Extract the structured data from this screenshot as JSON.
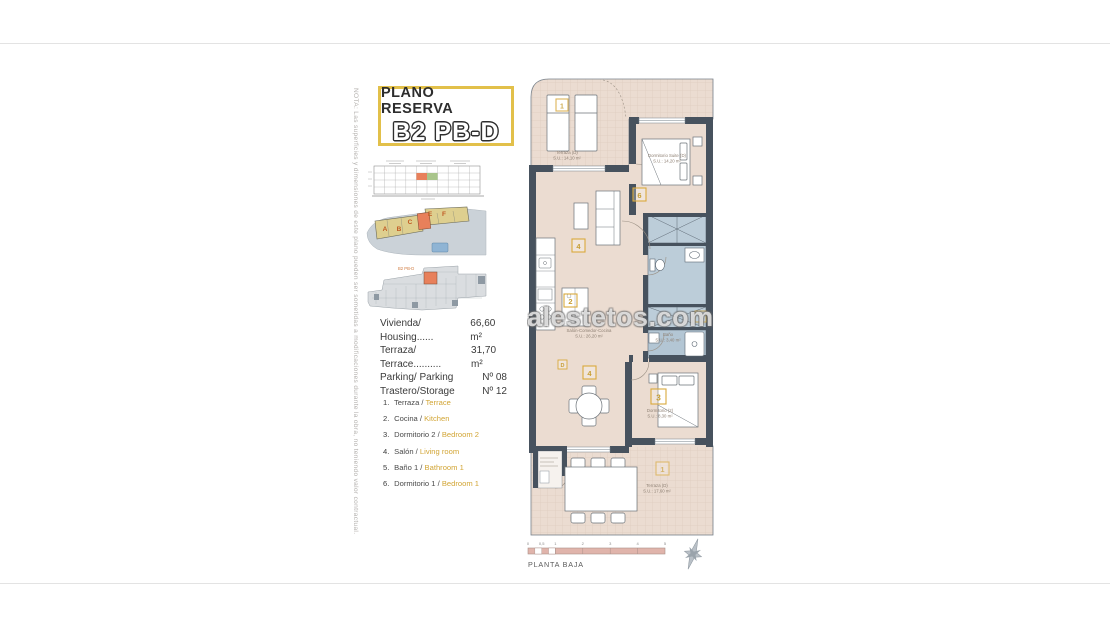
{
  "note": {
    "text": "NOTA: Las superficies y dimensiones de este plano pueden ser sometidas a modificaciones durante la obra, no teniendo valor contractual."
  },
  "title": {
    "line1": "PLANO RESERVA",
    "line2": "B2 PB-D"
  },
  "info": {
    "rows": [
      {
        "label": "Vivienda/ Housing......",
        "value": "66,60 m²"
      },
      {
        "label": "Terraza/ Terrace..........",
        "value": "31,70 m²"
      },
      {
        "label": "Parking/ Parking",
        "value": "Nº 08"
      },
      {
        "label": "Trastero/Storage",
        "value": "Nº 12"
      }
    ]
  },
  "legend": {
    "items": [
      {
        "num": "1.",
        "es": "Terraza /",
        "en": "Terrace"
      },
      {
        "num": "2.",
        "es": "Cocina /",
        "en": "Kitchen"
      },
      {
        "num": "3.",
        "es": "Dormitorio 2 /",
        "en": "Bedroom 2"
      },
      {
        "num": "4.",
        "es": "Salón /",
        "en": "Living room"
      },
      {
        "num": "5.",
        "es": "Baño 1 /",
        "en": "Bathroom 1"
      },
      {
        "num": "6.",
        "es": "Dormitorio 1 /",
        "en": "Bedroom 1"
      }
    ]
  },
  "plan": {
    "rooms": {
      "terrace_top": {
        "name": "Terraza (D)",
        "area": "S.U.: 14,10 m²"
      },
      "suite": {
        "name": "Dormitorio Suite (D)",
        "area": "S.U.: 14,20 m²"
      },
      "salon": {
        "name": "Salón-Comedor-Cocina",
        "area": "S.U.: 26,20 m²"
      },
      "bath": {
        "name": "Baño",
        "area": "S.U.: 3,40 m²"
      },
      "bedroom2": {
        "name": "Dormitorio (2)",
        "area": "S.U.: 8,30 m²"
      },
      "terrace_bottom": {
        "name": "Terraza (D)",
        "area": "S.U.: 17,60 m²"
      }
    },
    "tags": {
      "terrace_top": "1",
      "suite": "6",
      "living": "4",
      "kitchen": "2",
      "door": "D",
      "dining": "4",
      "bedroom2": "3",
      "bath": "5",
      "terrace_bottom": "1"
    }
  },
  "minimap": {
    "blocks": {
      "a": "A",
      "b": "B",
      "c": "C",
      "e": "E",
      "f": "F"
    },
    "unit_label": "B2 PB-D"
  },
  "scalebar": {
    "ticks": [
      "0",
      "0,5",
      "1",
      "2",
      "3",
      "4",
      "5"
    ],
    "caption": "PLANTA BAJA"
  },
  "watermark": {
    "text": "alestetos.com"
  },
  "colors": {
    "accent_yellow": "#E2C04A",
    "tag_yellow": "#D9A93C",
    "wall": "#47525E",
    "floor": "#EBDCD1",
    "wet_blue": "#BCCDD9",
    "highlight_orange": "#E8805B",
    "scale_pink": "#E0B4AB"
  }
}
